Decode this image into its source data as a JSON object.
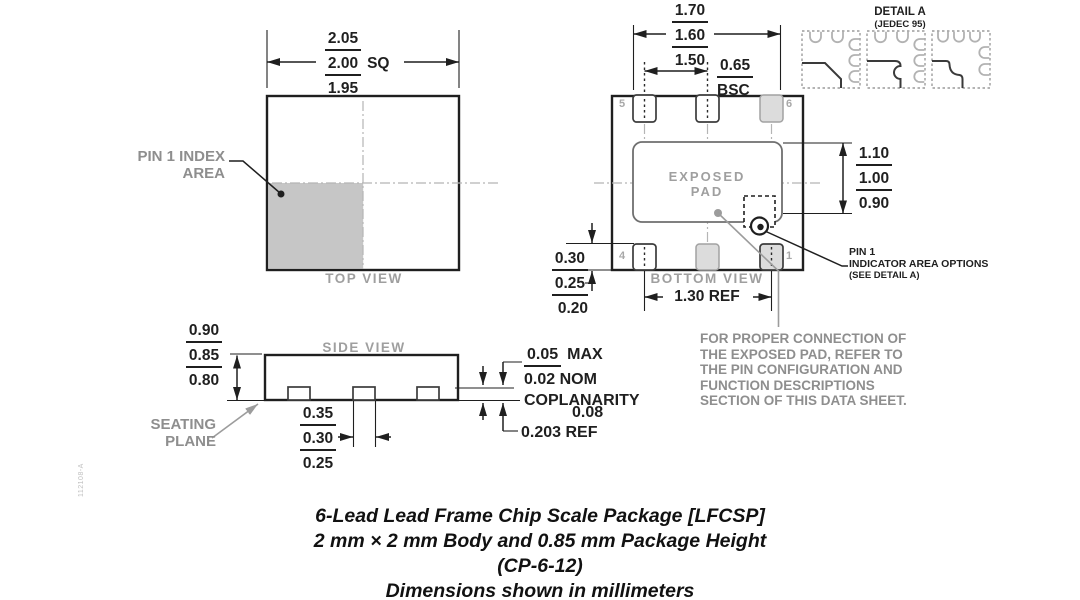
{
  "colors": {
    "ink": "#1f1f1f",
    "gray_label": "#8e8e8e",
    "pad_fill": "#dcdcdc",
    "index_area_fill": "#c6c6c6"
  },
  "top_view": {
    "label": "TOP VIEW",
    "pin1_index": {
      "line1": "PIN 1 INDEX",
      "line2": "AREA"
    },
    "dim_body": {
      "max": "2.05",
      "nom": "2.00",
      "suffix": "SQ",
      "min": "1.95"
    }
  },
  "bottom_view": {
    "label": "BOTTOM VIEW",
    "exposed_pad": {
      "line1": "EXPOSED",
      "line2": "PAD"
    },
    "pins": {
      "top_left": "5",
      "top_right": "6",
      "bottom_left": "4",
      "bottom_right": "1"
    },
    "dim_width": {
      "max": "1.70",
      "nom": "1.60",
      "min": "1.50"
    },
    "dim_pitch": {
      "value": "0.65",
      "suffix": "BSC"
    },
    "dim_exposed_pad": {
      "max": "1.10",
      "nom": "1.00",
      "min": "0.90"
    },
    "dim_lead_length": {
      "max": "0.30",
      "nom": "0.25",
      "min": "0.20"
    },
    "dim_lead_span": "1.30 REF",
    "pin1_indicator": {
      "line1": "PIN 1",
      "line2": "INDICATOR AREA OPTIONS",
      "line3": "(SEE DETAIL A)"
    }
  },
  "detail_a": {
    "title": "DETAIL A",
    "subtitle": "(JEDEC 95)"
  },
  "side_view": {
    "label": "SIDE VIEW",
    "dim_height": {
      "max": "0.90",
      "nom": "0.85",
      "min": "0.80"
    },
    "seating_plane": {
      "line1": "SEATING",
      "line2": "PLANE"
    },
    "dim_lead_width": {
      "max": "0.35",
      "nom": "0.30",
      "min": "0.25"
    },
    "coplanarity": {
      "max_value": "0.05",
      "max_suffix": "MAX",
      "nom_value": "0.02",
      "nom_suffix": "NOM",
      "label": "COPLANARITY",
      "value": "0.08"
    },
    "lead_thickness_ref": "0.203 REF"
  },
  "connection_note": {
    "line1": "FOR PROPER CONNECTION OF",
    "line2": "THE EXPOSED PAD, REFER TO",
    "line3": "THE PIN CONFIGURATION AND",
    "line4": "FUNCTION DESCRIPTIONS",
    "line5": "SECTION OF THIS DATA SHEET."
  },
  "caption": {
    "line1": "6-Lead Lead Frame Chip Scale Package [LFCSP]",
    "line2": "2 mm × 2 mm Body and 0.85 mm Package Height",
    "line3": "(CP-6-12)",
    "line4": "Dimensions shown in millimeters"
  },
  "revision_code": "112108-A"
}
